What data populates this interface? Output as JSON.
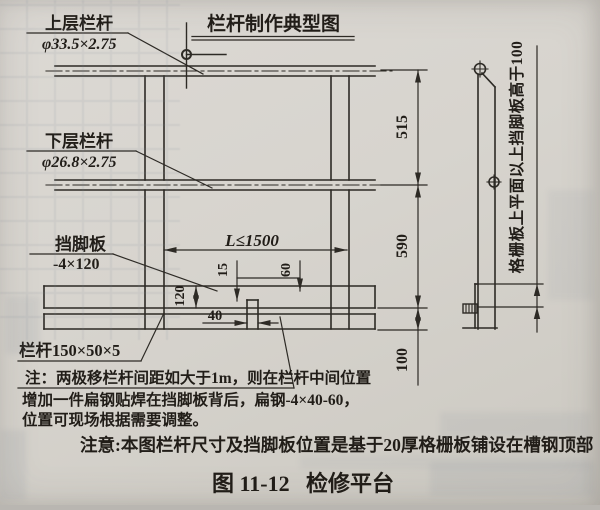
{
  "colors": {
    "paper": "#d7d4ce",
    "ink": "#2d2a25",
    "text": "#211d18"
  },
  "drawing": {
    "detail_title": "栏杆制作典型图",
    "upper_rail_label": "上层栏杆",
    "upper_rail_spec": "φ33.5×2.75",
    "lower_rail_label": "下层栏杆",
    "lower_rail_spec": "φ26.8×2.75",
    "toe_board_label": "挡脚板",
    "toe_board_spec": "-4×120",
    "post_spec": "栏杆150×50×5",
    "dim_515": "515",
    "dim_590": "590",
    "dim_100": "100",
    "dim_span": "L≤1500",
    "dim_15": "15",
    "dim_60": "60",
    "dim_120": "120",
    "dim_40": "40",
    "grating_note_vertical": "格栅板上平面以上挡脚板高于100"
  },
  "notes": {
    "line1": "注：两极移栏杆间距如大于1m，则在栏杆中间位置",
    "line2": "增加一件扁钢贴焊在挡脚板背后，扁钢-4×40-60，",
    "line3": "位置可现场根据需要调整。",
    "caution": "注意:本图栏杆尺寸及挡脚板位置是基于20厚格栅板铺设在槽钢顶部"
  },
  "caption": {
    "figure_no": "图 11-12",
    "figure_title": "检修平台"
  }
}
